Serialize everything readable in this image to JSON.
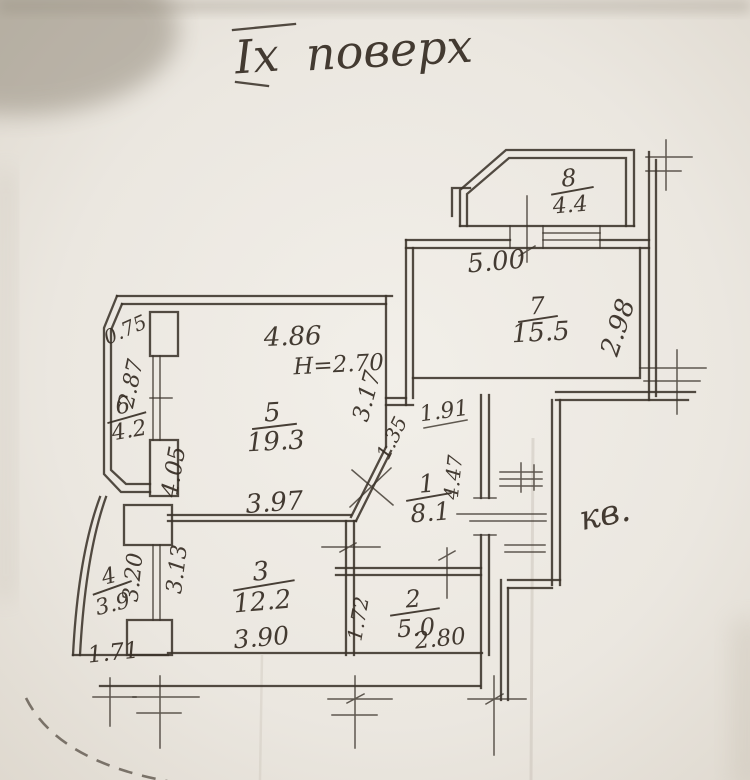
{
  "title": {
    "floor_roman": "Іх",
    "word": "поверх"
  },
  "annotation": "кв.",
  "rooms": [
    {
      "number": "1",
      "area": "8.1"
    },
    {
      "number": "2",
      "area": "5.0"
    },
    {
      "number": "3",
      "area": "12.2"
    },
    {
      "number": "4",
      "area": "3.9"
    },
    {
      "number": "5",
      "area": "19.3"
    },
    {
      "number": "6",
      "area": "4.2"
    },
    {
      "number": "7",
      "area": "15.5"
    },
    {
      "number": "8",
      "area": "4.4"
    }
  ],
  "dimensions": {
    "room5_top": "4.86",
    "ceiling_height": "H=2.70",
    "room5_bottom": "3.97",
    "room5_left": "4.05",
    "room5_right": "3.17",
    "room5_diag": "1.35",
    "room1_top": "1.91",
    "room1_right": "4.47",
    "room7_top": "5.00",
    "room7_right": "2.98",
    "room3_bottom": "3.90",
    "room3_left": "3.13",
    "room2_bottom": "2.80",
    "room2_left": "1.72",
    "room4_bottom": "1.71",
    "room4_right": "3.20",
    "room6_left": "2.87",
    "room6_chamfer": "0.75"
  },
  "colors": {
    "paper": "#eae6e0",
    "ink": "#3b332a"
  }
}
